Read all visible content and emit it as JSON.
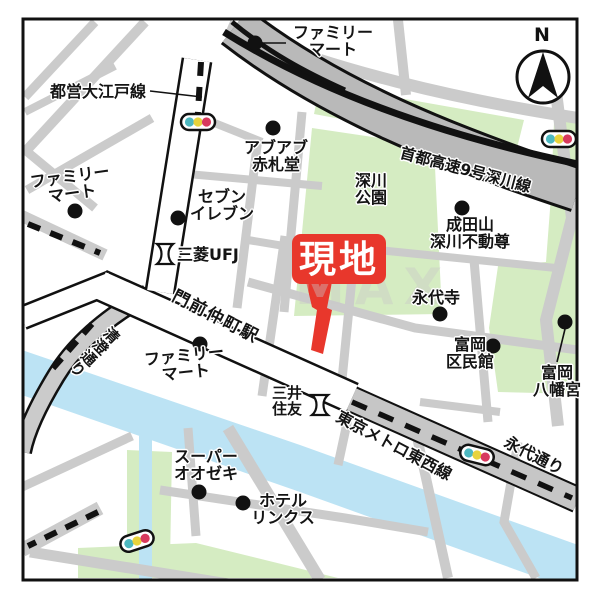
{
  "map_type": "japanese-neighborhood-access-map",
  "site": {
    "label": "現地"
  },
  "compass": {
    "label": "N"
  },
  "watermark": "MAX",
  "labels": {
    "toei_oedo": "都営大江戸線",
    "familymart_top": "ファミリー\nマート",
    "abuabu_akafudado": "アブアブ\n赤札堂",
    "shuto_expressway": "首都高速9号深川線",
    "fukagawa_park": "深川\n公園",
    "seven_eleven": "セブン\nイレブン",
    "mitsubishi_ufj": "三菱UFJ",
    "naritasan_fudoson": "成田山\n深川不動尊",
    "eitaiji": "永代寺",
    "monzen_nakacho_station": "門前仲町駅",
    "familymart_west": "ファミリー\nマート",
    "familymart_south": "ファミリー\nマート",
    "kiyosumi_dori": "清澄通り",
    "mitsui_sumitomo": "三井\n住友",
    "tokyo_metro_tozai_line": "東京メトロ東西線",
    "eitai_dori": "永代通り",
    "super_ozeki": "スーパー\nオオゼキ",
    "hotel_links": "ホテル\nリンクス",
    "tomioka_kuminkan": "富岡\n区民館",
    "tomioka_hachimangu": "富岡\n八幡宮"
  },
  "colors": {
    "road_gray": "#cbcbcb",
    "main_road_white": "#ffffff",
    "expressway_gray": "#b9b9b9",
    "park_green": "#d5ecc2",
    "river_blue": "#bce3f4",
    "outline_black": "#111111",
    "site_red": "#e8372c",
    "signal_teal": "#4db8c0",
    "signal_yellow": "#e8d33c",
    "signal_red": "#d83a5e"
  }
}
